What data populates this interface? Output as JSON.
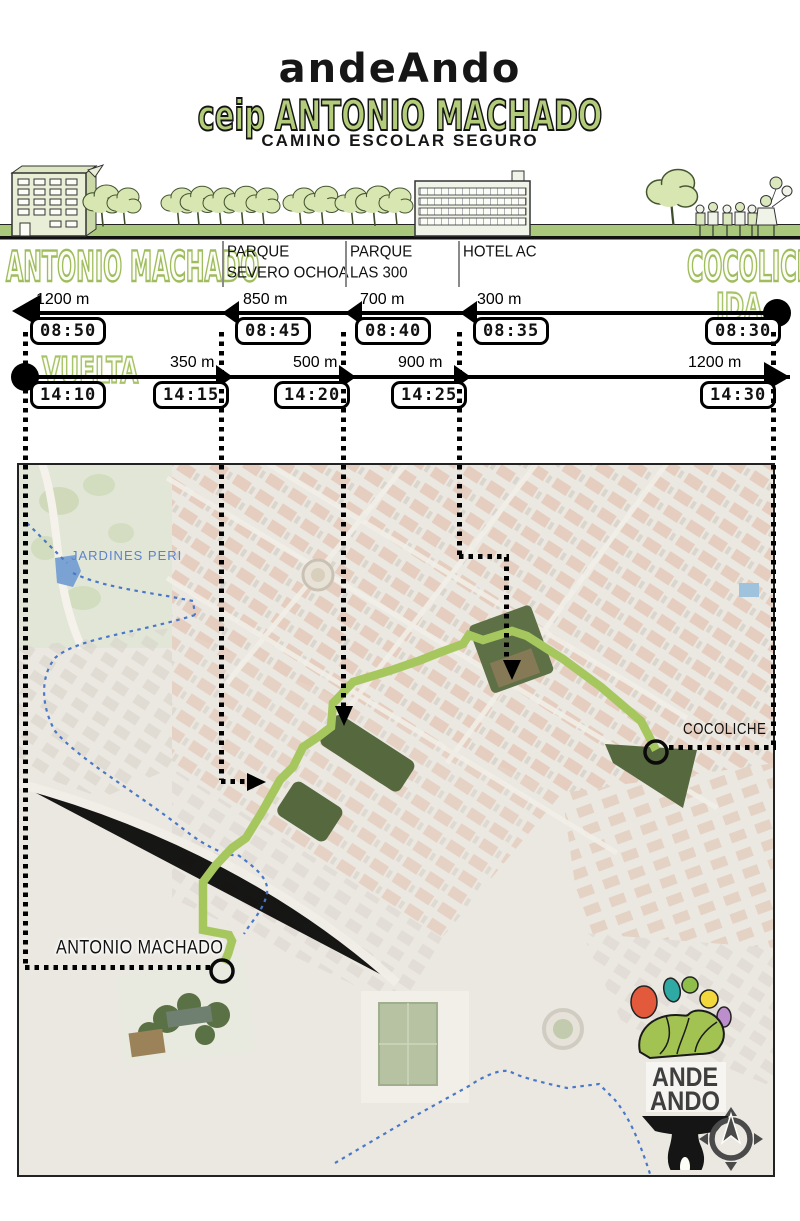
{
  "header": {
    "brand": "andeAndo",
    "school_line": "ceip ANTONIO MACHADO",
    "subtitle": "CAMINO ESCOLAR SEGURO"
  },
  "strip": {
    "origin_label": "ANTONIO MACHADO",
    "destination_label": "COCOLICHE",
    "waypoints": [
      {
        "line1": "PARQUE",
        "line2": "SEVERO OCHOA"
      },
      {
        "line1": "PARQUE",
        "line2": "LAS 300"
      },
      {
        "line1": "HOTEL AC",
        "line2": ""
      }
    ]
  },
  "timeline": {
    "ida": {
      "label": "IDA",
      "distances": [
        "1200 m",
        "850 m",
        "700 m",
        "300 m"
      ],
      "times": [
        "08:50",
        "08:45",
        "08:40",
        "08:35",
        "08:30"
      ]
    },
    "vuelta": {
      "label": "VUELTA",
      "distances": [
        "350 m",
        "500 m",
        "900 m",
        "1200 m"
      ],
      "times": [
        "14:10",
        "14:15",
        "14:20",
        "14:25",
        "14:30"
      ]
    }
  },
  "map": {
    "labels": {
      "park": "JARDINES PERI",
      "destination": "COCOLICHE",
      "origin": "ANTONIO MACHADO"
    },
    "logo": {
      "line1": "ANDE",
      "line2": "ANDO"
    }
  },
  "colors": {
    "brand_green": "#b3cc79",
    "route_green": "#a6c75e",
    "boundary_blue": "#4a78c8",
    "map_park_green": "#55683e",
    "jardines_blue": "#5b83cc",
    "logo_foot_green": "#a2c351"
  }
}
